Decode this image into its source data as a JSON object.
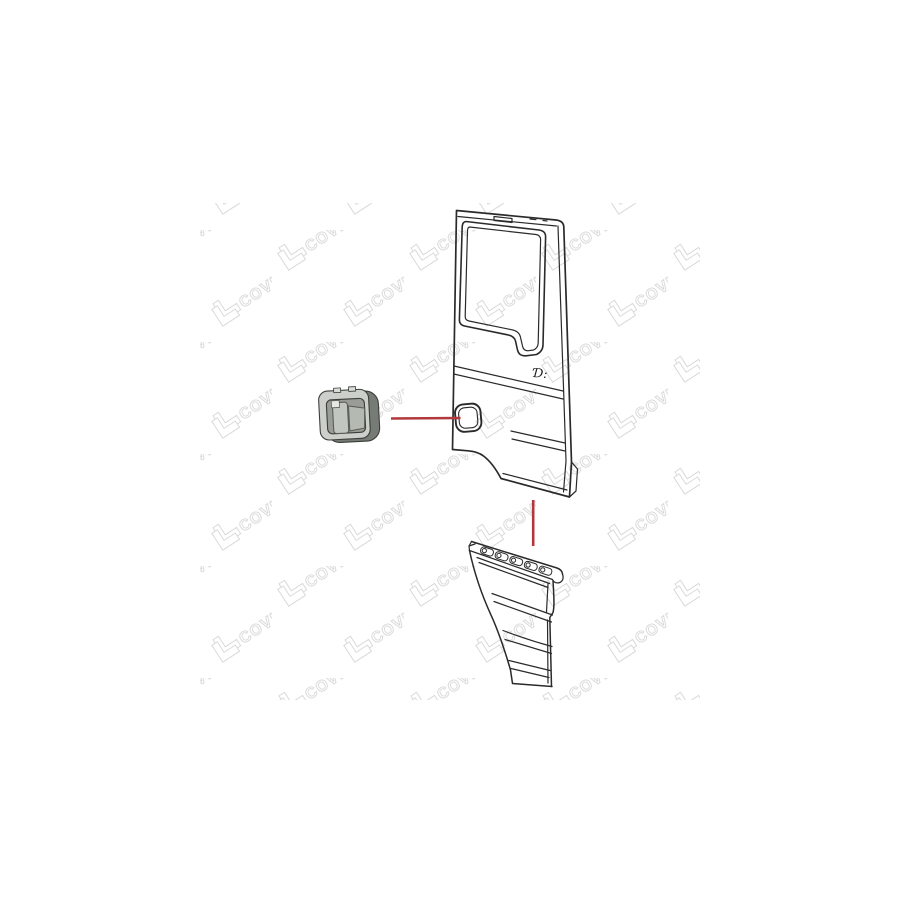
{
  "page": {
    "background_color": "#ffffff"
  },
  "product_image": {
    "watermark": {
      "text": "COVIND",
      "logo_icon": "covind-angle-logo",
      "color": "#d9d9d9",
      "rotation_deg": -33
    },
    "drawing": {
      "stroke_color": "#2a2a2a",
      "callout_color": "#b2383c",
      "door_emblem_text": "Ɗ:",
      "handle_colors": {
        "face": "#ccd0ca",
        "recess": "#989d97",
        "side": "#767b75",
        "grip": "#c2c6c0",
        "flap": "#b4b9b2",
        "key_square": "#e6e8e3"
      }
    }
  }
}
